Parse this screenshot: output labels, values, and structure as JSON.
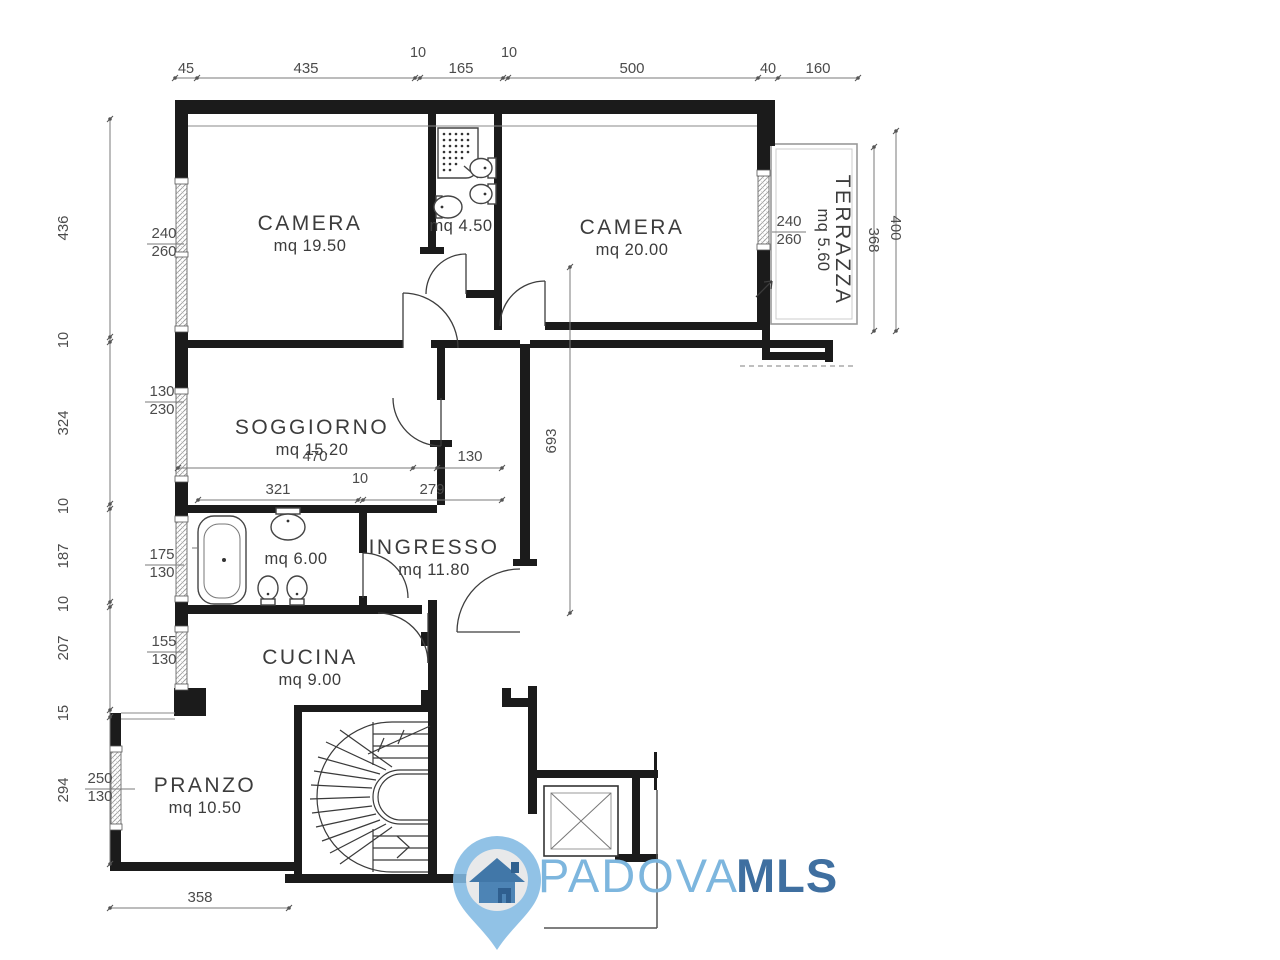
{
  "logo": {
    "name": "PADOVA",
    "suffix": "MLS",
    "colors": {
      "light_blue": "#7db6de",
      "dark_blue": "#3f6fa0",
      "pin_ring": "#82b9e2",
      "pin_inner": "#e8e9ea",
      "house_roof": "#4177a8",
      "house_body": "#4d84b5",
      "house_door": "#2f5f8f"
    }
  },
  "plan": {
    "rooms": [
      {
        "name": "CAMERA",
        "area": "mq 19.50",
        "nx": 310,
        "ny": 230,
        "ax": 310,
        "ay": 251,
        "rot": 0
      },
      {
        "name": "CAMERA",
        "area": "mq 20.00",
        "nx": 632,
        "ny": 234,
        "ax": 632,
        "ay": 255,
        "rot": 0
      },
      {
        "name": "SOGGIORNO",
        "area": "mq 15.20",
        "nx": 312,
        "ny": 434,
        "ax": 312,
        "ay": 455,
        "rot": 0
      },
      {
        "name": "INGRESSO",
        "area": "mq 11.80",
        "nx": 434,
        "ny": 554,
        "ax": 434,
        "ay": 575,
        "rot": 0
      },
      {
        "name": "CUCINA",
        "area": "mq 9.00",
        "nx": 310,
        "ny": 664,
        "ax": 310,
        "ay": 685,
        "rot": 0
      },
      {
        "name": "PRANZO",
        "area": "mq 10.50",
        "nx": 205,
        "ny": 792,
        "ax": 205,
        "ay": 813,
        "rot": 0
      },
      {
        "name": "TERRAZZA",
        "area": "mq 5.60",
        "nx": 836,
        "ny": 240,
        "ax": 818,
        "ay": 240,
        "rot": 90
      },
      {
        "name": "",
        "area": "mq 4.50",
        "nx": 0,
        "ny": 0,
        "ax": 461,
        "ay": 231,
        "rot": 0
      },
      {
        "name": "",
        "area": "mq 6.00",
        "nx": 0,
        "ny": 0,
        "ax": 296,
        "ay": 564,
        "rot": 0
      }
    ],
    "dim_lines": [
      {
        "id": "top",
        "axis": "h",
        "x1": 175,
        "y1": 78,
        "x2": 858,
        "y2": 78,
        "ticks": [
          175,
          197,
          415,
          420,
          503,
          508,
          758,
          778,
          858
        ]
      },
      {
        "id": "left",
        "axis": "v",
        "x1": 110,
        "y1": 119,
        "x2": 110,
        "y2": 864,
        "ticks": [
          119,
          337,
          342,
          504,
          509,
          602,
          607,
          710,
          717,
          864
        ]
      },
      {
        "id": "soggiorno-1",
        "axis": "h",
        "x1": 178,
        "y1": 468,
        "x2": 502,
        "y2": 468,
        "ticks": [
          178,
          413,
          437,
          502
        ]
      },
      {
        "id": "soggiorno-2",
        "axis": "h",
        "x1": 198,
        "y1": 500,
        "x2": 502,
        "y2": 500,
        "ticks": [
          198,
          358,
          363,
          502
        ]
      },
      {
        "id": "corridor",
        "axis": "v",
        "x1": 570,
        "y1": 267,
        "x2": 570,
        "y2": 613,
        "ticks": [
          267,
          613
        ]
      },
      {
        "id": "pranzo",
        "axis": "h",
        "x1": 110,
        "y1": 908,
        "x2": 289,
        "y2": 908,
        "ticks": [
          110,
          289
        ]
      },
      {
        "id": "terrace-368",
        "axis": "v",
        "x1": 874,
        "y1": 147,
        "x2": 874,
        "y2": 331,
        "ticks": [
          147,
          331
        ]
      },
      {
        "id": "terrace-400",
        "axis": "v",
        "x1": 896,
        "y1": 131,
        "x2": 896,
        "y2": 331,
        "ticks": [
          131,
          331
        ]
      }
    ],
    "dim_labels": [
      {
        "text": "45",
        "x": 186,
        "y": 73,
        "rot": 0
      },
      {
        "text": "435",
        "x": 306,
        "y": 73,
        "rot": 0
      },
      {
        "text": "10",
        "x": 418,
        "y": 57,
        "rot": 0
      },
      {
        "text": "165",
        "x": 461,
        "y": 73,
        "rot": 0
      },
      {
        "text": "10",
        "x": 509,
        "y": 57,
        "rot": 0
      },
      {
        "text": "500",
        "x": 632,
        "y": 73,
        "rot": 0
      },
      {
        "text": "40",
        "x": 768,
        "y": 73,
        "rot": 0
      },
      {
        "text": "160",
        "x": 818,
        "y": 73,
        "rot": 0
      },
      {
        "text": "436",
        "x": 68,
        "y": 228,
        "rot": -90
      },
      {
        "text": "10",
        "x": 68,
        "y": 340,
        "rot": -90
      },
      {
        "text": "324",
        "x": 68,
        "y": 423,
        "rot": -90
      },
      {
        "text": "10",
        "x": 68,
        "y": 506,
        "rot": -90
      },
      {
        "text": "187",
        "x": 68,
        "y": 556,
        "rot": -90
      },
      {
        "text": "10",
        "x": 68,
        "y": 604,
        "rot": -90
      },
      {
        "text": "207",
        "x": 68,
        "y": 648,
        "rot": -90
      },
      {
        "text": "15",
        "x": 68,
        "y": 713,
        "rot": -90
      },
      {
        "text": "294",
        "x": 68,
        "y": 790,
        "rot": -90
      },
      {
        "text": "470",
        "x": 315,
        "y": 461,
        "rot": 0
      },
      {
        "text": "130",
        "x": 470,
        "y": 461,
        "rot": 0
      },
      {
        "text": "321",
        "x": 278,
        "y": 494,
        "rot": 0
      },
      {
        "text": "10",
        "x": 360,
        "y": 483,
        "rot": 0
      },
      {
        "text": "279",
        "x": 432,
        "y": 494,
        "rot": 0
      },
      {
        "text": "693",
        "x": 556,
        "y": 441,
        "rot": -90
      },
      {
        "text": "358",
        "x": 200,
        "y": 902,
        "rot": 0
      },
      {
        "text": "240",
        "x": 164,
        "y": 238,
        "rot": 0
      },
      {
        "text": "260",
        "x": 164,
        "y": 256,
        "rot": 0
      },
      {
        "text": "130",
        "x": 162,
        "y": 396,
        "rot": 0
      },
      {
        "text": "230",
        "x": 162,
        "y": 414,
        "rot": 0
      },
      {
        "text": "175",
        "x": 162,
        "y": 559,
        "rot": 0
      },
      {
        "text": "130",
        "x": 162,
        "y": 577,
        "rot": 0
      },
      {
        "text": "155",
        "x": 164,
        "y": 646,
        "rot": 0
      },
      {
        "text": "130",
        "x": 164,
        "y": 664,
        "rot": 0
      },
      {
        "text": "250",
        "x": 100,
        "y": 783,
        "rot": 0
      },
      {
        "text": "130",
        "x": 100,
        "y": 801,
        "rot": 0
      },
      {
        "text": "240",
        "x": 789,
        "y": 226,
        "rot": 0
      },
      {
        "text": "260",
        "x": 789,
        "y": 244,
        "rot": 0
      },
      {
        "text": "368",
        "x": 869,
        "y": 240,
        "rot": 90
      },
      {
        "text": "400",
        "x": 891,
        "y": 228,
        "rot": 90
      }
    ],
    "leaders": [
      [
        147,
        244,
        184,
        244
      ],
      [
        145,
        402,
        184,
        402
      ],
      [
        145,
        565,
        184,
        565
      ],
      [
        147,
        652,
        184,
        652
      ],
      [
        85,
        789,
        135,
        789
      ],
      [
        772,
        232,
        806,
        232
      ]
    ]
  }
}
